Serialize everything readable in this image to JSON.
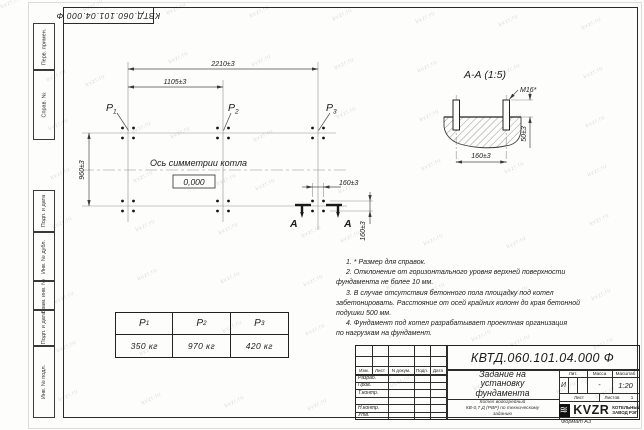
{
  "page": {
    "watermark": "kvzr.ru",
    "format_label": "Формат А3"
  },
  "margin_stamp": {
    "doc_number_rotated": "КВТД.060.101.04.000  Ф",
    "left_labels": [
      "Перв. примен.",
      "Справ. №",
      "Подп. и дата",
      "Инв. № дубл.",
      "Взам. инв. №",
      "Подп. и дата",
      "Инв. № подл."
    ]
  },
  "plan": {
    "dim_overall": "2210±3",
    "dim_half": "1105±3",
    "dim_height": "960±3",
    "dim_bolt_horiz": "160±3",
    "dim_bolt_vert": "160±3",
    "axis_label": "Ось симметрии котла",
    "level_mark": "0,000",
    "load_labels": [
      {
        "name": "P",
        "sub": "1"
      },
      {
        "name": "P",
        "sub": "2"
      },
      {
        "name": "P",
        "sub": "3"
      }
    ],
    "section_letter_left": "А",
    "section_letter_right": "А"
  },
  "section": {
    "title": "А-А (1:5)",
    "thread": "М16*",
    "dim_protrusion": "50±3",
    "dim_spacing": "160±3"
  },
  "notes": {
    "lines": [
      {
        "text": "1. * Размер для справок.",
        "indent": true
      },
      {
        "text": "2. Отклонение от горизонтального уровня верхней поверхности",
        "indent": true
      },
      {
        "text": "фундамента не более 10 мм.",
        "indent": false
      },
      {
        "text": "3. В случае отсутствия бетонного пола площадку под котел",
        "indent": true
      },
      {
        "text": "забетонировать. Расстояние от осей крайних колонн до края бетонной",
        "indent": false
      },
      {
        "text": "подушки 500 мм.",
        "indent": false
      },
      {
        "text": "4. Фундамент под котел разрабатывает проектная организация",
        "indent": true
      },
      {
        "text": "по нагрузкам на фундамент.",
        "indent": false
      }
    ]
  },
  "load_table": {
    "headers": [
      {
        "name": "P",
        "sub": "1"
      },
      {
        "name": "P",
        "sub": "2"
      },
      {
        "name": "P",
        "sub": "3"
      }
    ],
    "values": [
      "350 кг",
      "970 кг",
      "420 кг"
    ]
  },
  "title_block": {
    "doc_number": "КВТД.060.101.04.000  Ф",
    "title_lines": [
      "Задание на",
      "установку",
      "фундамента"
    ],
    "product_lines": [
      "Котел водогрейный",
      "КВ-0,7 Д (РВР) по техническому",
      "заданию"
    ],
    "col_headers": [
      "Изм.",
      "Лист",
      "N докум.",
      "Подп.",
      "Дата"
    ],
    "row_labels": [
      "Разраб.",
      "Пров.",
      "Т.контр.",
      "Н.контр.",
      "Утв."
    ],
    "lit_header": "Лит.",
    "lit_value": "И",
    "mass_header": "Масса",
    "mass_value": "-",
    "scale_header": "Масштаб",
    "scale_value": "1:20",
    "sheet_label": "Лист",
    "sheets_label": "Листов",
    "sheets_value": "1",
    "logo_icon": "wave-emblem-icon",
    "logo_glyph": "≋",
    "logo_text": "KVZR",
    "company_line1": "КОТЕЛЬНЫЙ",
    "company_line2": "ЗАВОД РЭП"
  }
}
